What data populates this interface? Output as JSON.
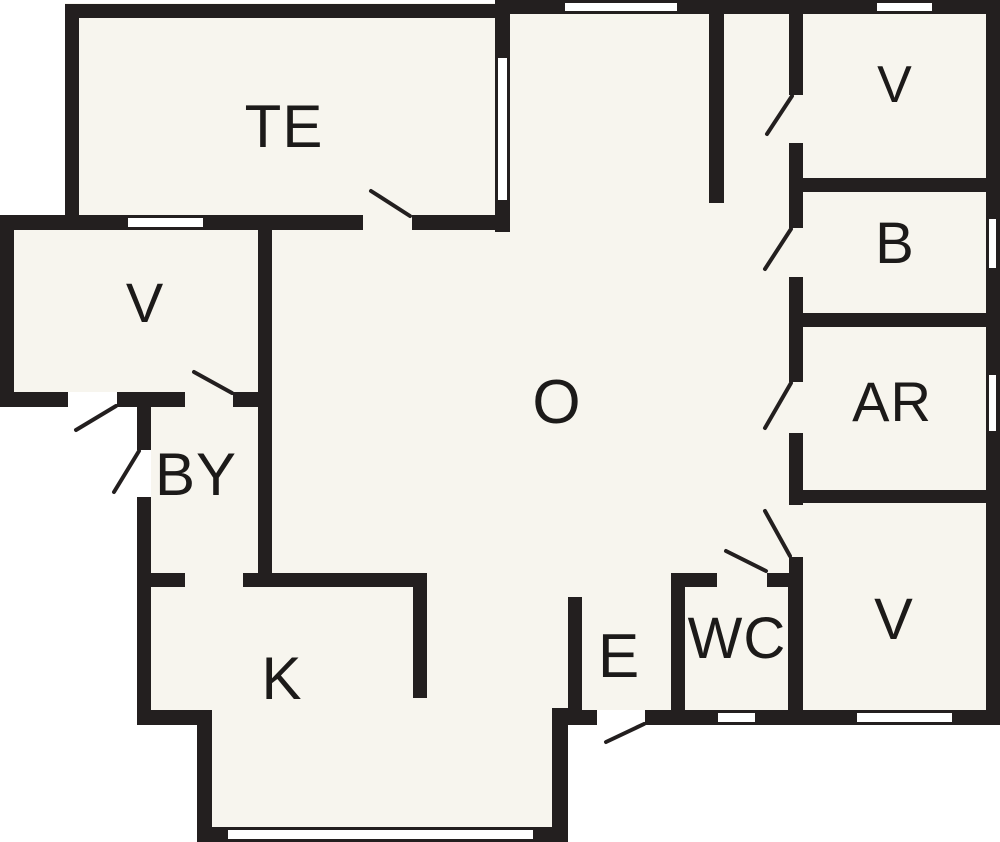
{
  "figure_type": "floor-plan",
  "colors": {
    "wall": "#231f1f",
    "floor": "#f7f5ee",
    "outside": "#ffffff",
    "label": "#1c1a19"
  },
  "rooms": [
    {
      "id": "te",
      "label": "TE"
    },
    {
      "id": "v-left",
      "label": "V"
    },
    {
      "id": "by",
      "label": "BY"
    },
    {
      "id": "k",
      "label": "K"
    },
    {
      "id": "o",
      "label": "O"
    },
    {
      "id": "e",
      "label": "E"
    },
    {
      "id": "wc",
      "label": "WC"
    },
    {
      "id": "v-bottom-right",
      "label": "V"
    },
    {
      "id": "ar",
      "label": "AR"
    },
    {
      "id": "b",
      "label": "B"
    },
    {
      "id": "v-top-right",
      "label": "V"
    }
  ]
}
